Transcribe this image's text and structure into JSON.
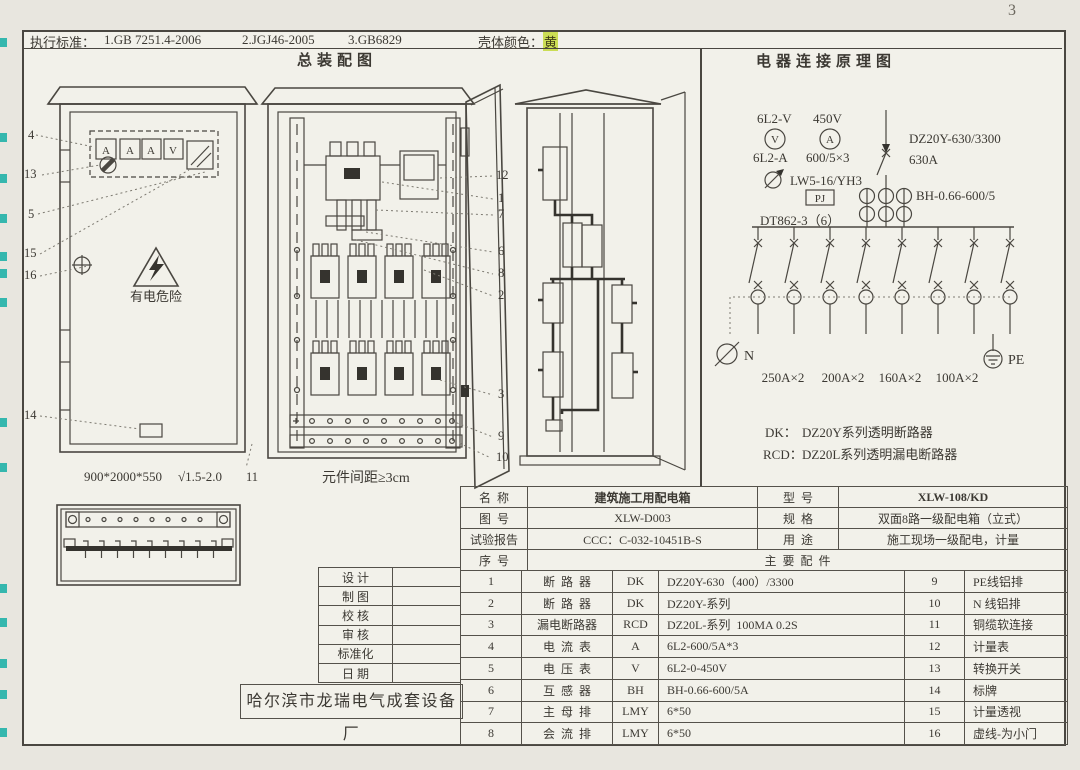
{
  "page": {
    "number": "3"
  },
  "colors": {
    "highlight_teal": "#35b7ae",
    "highlight_yellow": "#cbdd55",
    "ink": "#3c3933"
  },
  "header": {
    "standards_label": "执行标准：",
    "standards": [
      "1.GB 7251.4-2006",
      "2.JGJ46-2005",
      "3.GB6829"
    ],
    "shell_color_label": "壳体颜色：",
    "shell_color_value": "黄"
  },
  "assembly": {
    "title": "总装配图",
    "front_view": {
      "meter_labels": [
        "A",
        "A",
        "A",
        "V"
      ],
      "warning_text": "有电危险",
      "dimensions": "900*2000*550",
      "surface_mark": "√1.5-2.0",
      "callouts_left": [
        "4",
        "13",
        "5",
        "15",
        "16",
        "14"
      ],
      "callout_corner": "11"
    },
    "open_view": {
      "caption": "元件间距≥3cm",
      "callouts_right": [
        "12",
        "1",
        "7",
        "6",
        "8",
        "2",
        "3",
        "9",
        "10"
      ]
    }
  },
  "schematic": {
    "title": "电器连接原理图",
    "voltmeter_model": "6L2-V",
    "voltmeter_range": "450V",
    "voltmeter_symbol": "V",
    "ammeter_symbol": "A",
    "ammeter_model": "6L2-A",
    "ct_ratio": "600/5×3",
    "changeover_switch": "LW5-16/YH3",
    "meter_tag": "PJ",
    "energy_meter": "DT862-3（6）",
    "main_breaker": "DZ20Y-630/3300",
    "main_current": "630A",
    "current_transformer": "BH-0.66-600/5",
    "neutral": "N",
    "earth": "PE",
    "branch_ratings": [
      "250A×2",
      "200A×2",
      "160A×2",
      "100A×2"
    ],
    "legend": [
      {
        "code": "DK：",
        "desc": "DZ20Y系列透明断路器"
      },
      {
        "code": "RCD：",
        "desc": "DZ20L系列透明漏电断路器"
      }
    ]
  },
  "title_block": {
    "sign_rows": [
      "设 计",
      "制 图",
      "校 核",
      "审 核",
      "标准化",
      "日 期"
    ],
    "company": "哈尔滨市龙瑞电气成套设备厂"
  },
  "spec_table": {
    "info_rows": [
      {
        "label": "名  称",
        "value": "建筑施工用配电箱",
        "label2": "型  号",
        "value2": "XLW-108/KD"
      },
      {
        "label": "图  号",
        "value": "XLW-D003",
        "label2": "规  格",
        "value2": "双面8路一级配电箱（立式）"
      },
      {
        "label": "试验报告",
        "value": "CCC：C-032-10451B-S",
        "label2": "用  途",
        "value2": "施工现场一级配电，计量"
      }
    ],
    "seq_header": "序  号",
    "parts_header": "主  要  配  件",
    "parts": [
      {
        "no": "1",
        "name": "断  路  器",
        "code": "DK",
        "spec": "DZ20Y-630（400）/3300",
        "no2": "9",
        "name2": "PE线铝排"
      },
      {
        "no": "2",
        "name": "断  路  器",
        "code": "DK",
        "spec": "DZ20Y-系列",
        "no2": "10",
        "name2": "N 线铝排"
      },
      {
        "no": "3",
        "name": "漏电断路器",
        "code": "RCD",
        "spec": "DZ20L-系列  100MA 0.2S",
        "no2": "11",
        "name2": "铜缆软连接"
      },
      {
        "no": "4",
        "name": "电  流  表",
        "code": "A",
        "spec": "6L2-600/5A*3",
        "no2": "12",
        "name2": "计量表"
      },
      {
        "no": "5",
        "name": "电  压  表",
        "code": "V",
        "spec": "6L2-0-450V",
        "no2": "13",
        "name2": "转换开关"
      },
      {
        "no": "6",
        "name": "互  感  器",
        "code": "BH",
        "spec": "BH-0.66-600/5A",
        "no2": "14",
        "name2": "标牌"
      },
      {
        "no": "7",
        "name": "主  母  排",
        "code": "LMY",
        "spec": "6*50",
        "no2": "15",
        "name2": "计量透视"
      },
      {
        "no": "8",
        "name": "会  流  排",
        "code": "LMY",
        "spec": "6*50",
        "no2": "16",
        "name2": "虚线-为小门"
      }
    ]
  }
}
